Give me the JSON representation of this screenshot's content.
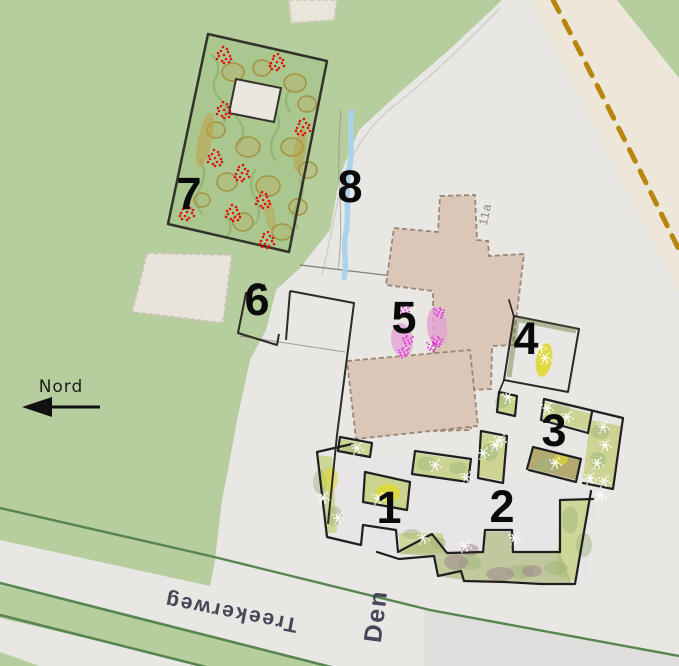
{
  "map": {
    "title": "Hand-annotated garden site plan",
    "texts": {
      "north_label": "Nord",
      "street_main": "Treekerweg",
      "street_secondary": "Den",
      "house_number": "11a"
    },
    "region_labels": [
      {
        "id": "1",
        "text": "1"
      },
      {
        "id": "2",
        "text": "2"
      },
      {
        "id": "3",
        "text": "3"
      },
      {
        "id": "4",
        "text": "4"
      },
      {
        "id": "5",
        "text": "5"
      },
      {
        "id": "6",
        "text": "6"
      },
      {
        "id": "7",
        "text": "7"
      },
      {
        "id": "8",
        "text": "8"
      }
    ],
    "colors": {
      "field_green": "#b6cd9e",
      "field_green_dark": "#a5c095",
      "yard_white": "#e9e7e4",
      "path_cream": "#ece7d8",
      "dashed_boundary": "#b8860b",
      "road_edge_green": "#57854f",
      "building_fill": "#dbc7b8",
      "building_edge": "#9b8674",
      "stream_blue": "#a8d2ee",
      "woodland_green": "#a9c78e",
      "tree_olive": "#bfa04c",
      "bed_green": "#c6d07e",
      "bed_olive": "#a79a55",
      "bed_purple": "#96718a",
      "blob_yellow": "#ded832",
      "blob_pink": "#e3a2d4",
      "marker_red": "#e31010",
      "marker_white": "#ffffff",
      "marker_magenta": "#e318e3",
      "label_black": "#0a0a0a",
      "street_text": "#4a4458"
    },
    "markers": {
      "red_flower_clusters": [
        [
          224,
          55
        ],
        [
          277,
          62
        ],
        [
          224,
          110
        ],
        [
          303,
          127
        ],
        [
          215,
          158
        ],
        [
          242,
          173
        ],
        [
          263,
          200
        ],
        [
          187,
          212
        ],
        [
          233,
          213
        ],
        [
          267,
          240
        ]
      ],
      "white_plant_marks": [
        [
          357,
          448
        ],
        [
          435,
          465
        ],
        [
          466,
          477
        ],
        [
          323,
          498
        ],
        [
          338,
          518
        ],
        [
          378,
          498
        ],
        [
          423,
          538
        ],
        [
          495,
          445
        ],
        [
          483,
          453
        ],
        [
          508,
          397
        ],
        [
          500,
          440
        ],
        [
          547,
          408
        ],
        [
          567,
          417
        ],
        [
          603,
          427
        ],
        [
          605,
          445
        ],
        [
          597,
          463
        ],
        [
          555,
          463
        ],
        [
          514,
          538
        ],
        [
          540,
          347
        ],
        [
          545,
          358
        ],
        [
          590,
          478
        ],
        [
          604,
          481
        ],
        [
          600,
          495
        ],
        [
          465,
          546
        ]
      ],
      "magenta_plant_marks": [
        [
          405,
          310
        ],
        [
          439,
          312
        ],
        [
          408,
          340
        ],
        [
          437,
          341
        ],
        [
          404,
          352
        ],
        [
          432,
          346
        ]
      ]
    }
  }
}
